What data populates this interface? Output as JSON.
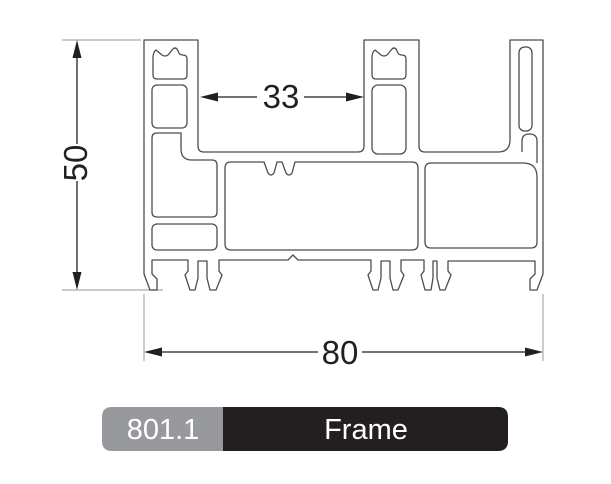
{
  "drawing": {
    "type": "profile-cross-section",
    "dimensions": {
      "height": "50",
      "inner_width": "33",
      "total_width": "80"
    },
    "label": {
      "code": "801.1",
      "name": "Frame"
    },
    "colors": {
      "background": "#ffffff",
      "profile_line": "#4d4d4f",
      "dimension_line": "#231f20",
      "extension_line": "#a8aaab",
      "label_code_bg": "#98999c",
      "label_name_bg": "#231f20",
      "label_text": "#ffffff"
    }
  }
}
